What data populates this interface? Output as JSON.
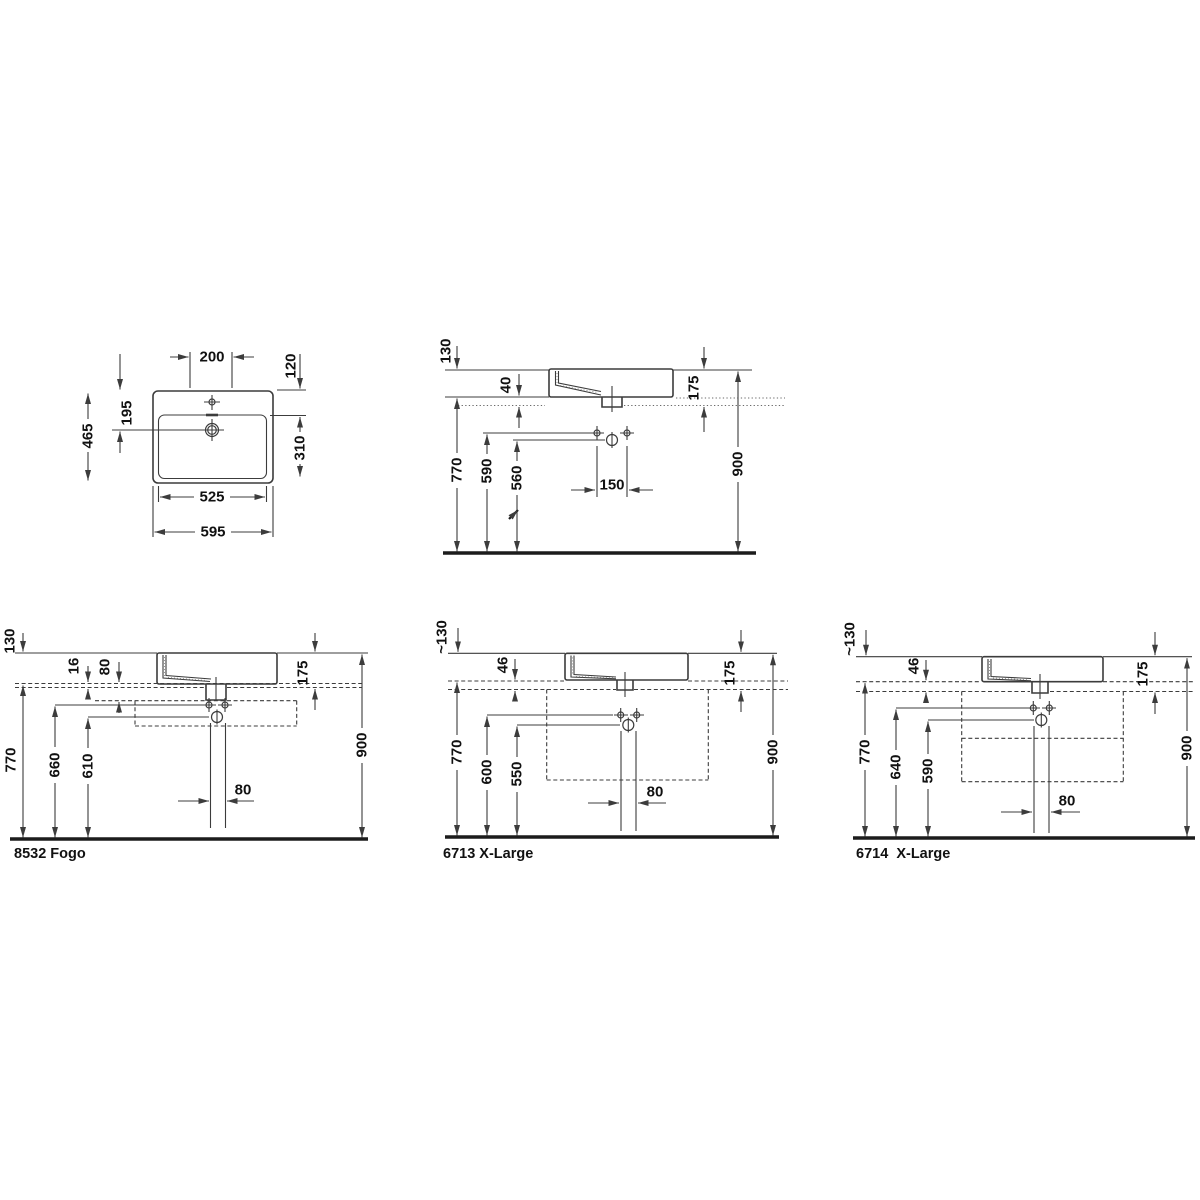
{
  "drawings": {
    "plan": {
      "dims": {
        "w200": "200",
        "h120": "120",
        "h195": "195",
        "h465": "465",
        "h310": "310",
        "w525": "525",
        "w595": "595"
      }
    },
    "elevation": {
      "dims": {
        "h130": "130",
        "t40": "40",
        "r175": "175",
        "f770": "770",
        "s590": "590",
        "d560": "560",
        "sp150": "150",
        "t900": "900"
      }
    },
    "fogo": {
      "label": "8532 Fogo",
      "dims": {
        "h130": "130",
        "p16": "16",
        "r80": "80",
        "r175": "175",
        "f770": "770",
        "s660": "660",
        "d610": "610",
        "pipe80": "80",
        "t900": "900"
      }
    },
    "x6713": {
      "label": "6713 X-Large",
      "dims": {
        "h130": "~130",
        "p46": "46",
        "r175": "175",
        "f770": "770",
        "s600": "600",
        "d550": "550",
        "pipe80": "80",
        "t900": "900"
      }
    },
    "x6714": {
      "label": "6714  X-Large",
      "dims": {
        "h130": "~130",
        "p46": "46",
        "r175": "175",
        "f770": "770",
        "s640": "640",
        "d590": "590",
        "pipe80": "80",
        "t900": "900"
      }
    }
  },
  "colors": {
    "line": "#3c3c3c",
    "text": "#111111",
    "background": "#ffffff"
  }
}
